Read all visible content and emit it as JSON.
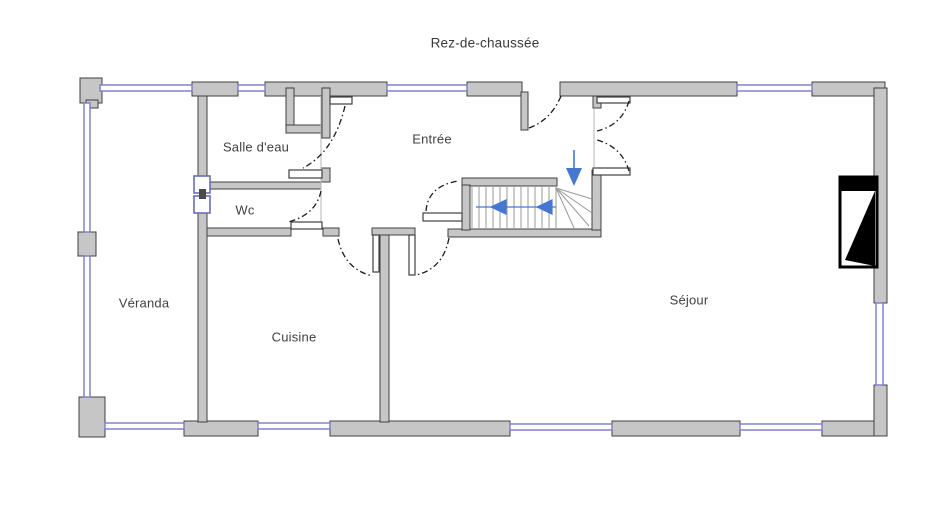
{
  "title": "Rez-de-chaussée",
  "rooms": [
    {
      "id": "salle-deau",
      "label": "Salle d'eau"
    },
    {
      "id": "wc",
      "label": "Wc"
    },
    {
      "id": "entree",
      "label": "Entrée"
    },
    {
      "id": "veranda",
      "label": "Véranda"
    },
    {
      "id": "cuisine",
      "label": "Cuisine"
    },
    {
      "id": "sejour",
      "label": "Séjour"
    }
  ],
  "stair": {
    "path_arrow_direction": "left",
    "entry_arrow_direction": "down"
  },
  "symbols": [
    "fireplace-icon",
    "stair-direction-arrow",
    "stair-entry-arrow",
    "interior-window-symbol",
    "door-swing-arc",
    "window-glazing"
  ],
  "colors": {
    "wall_fill": "#c6c6c6",
    "wall_outline": "#404040",
    "window_blue": "#7b7bc8",
    "arrow_blue": "#4677d0",
    "text": "#3f3f3f",
    "background": "#ffffff"
  }
}
